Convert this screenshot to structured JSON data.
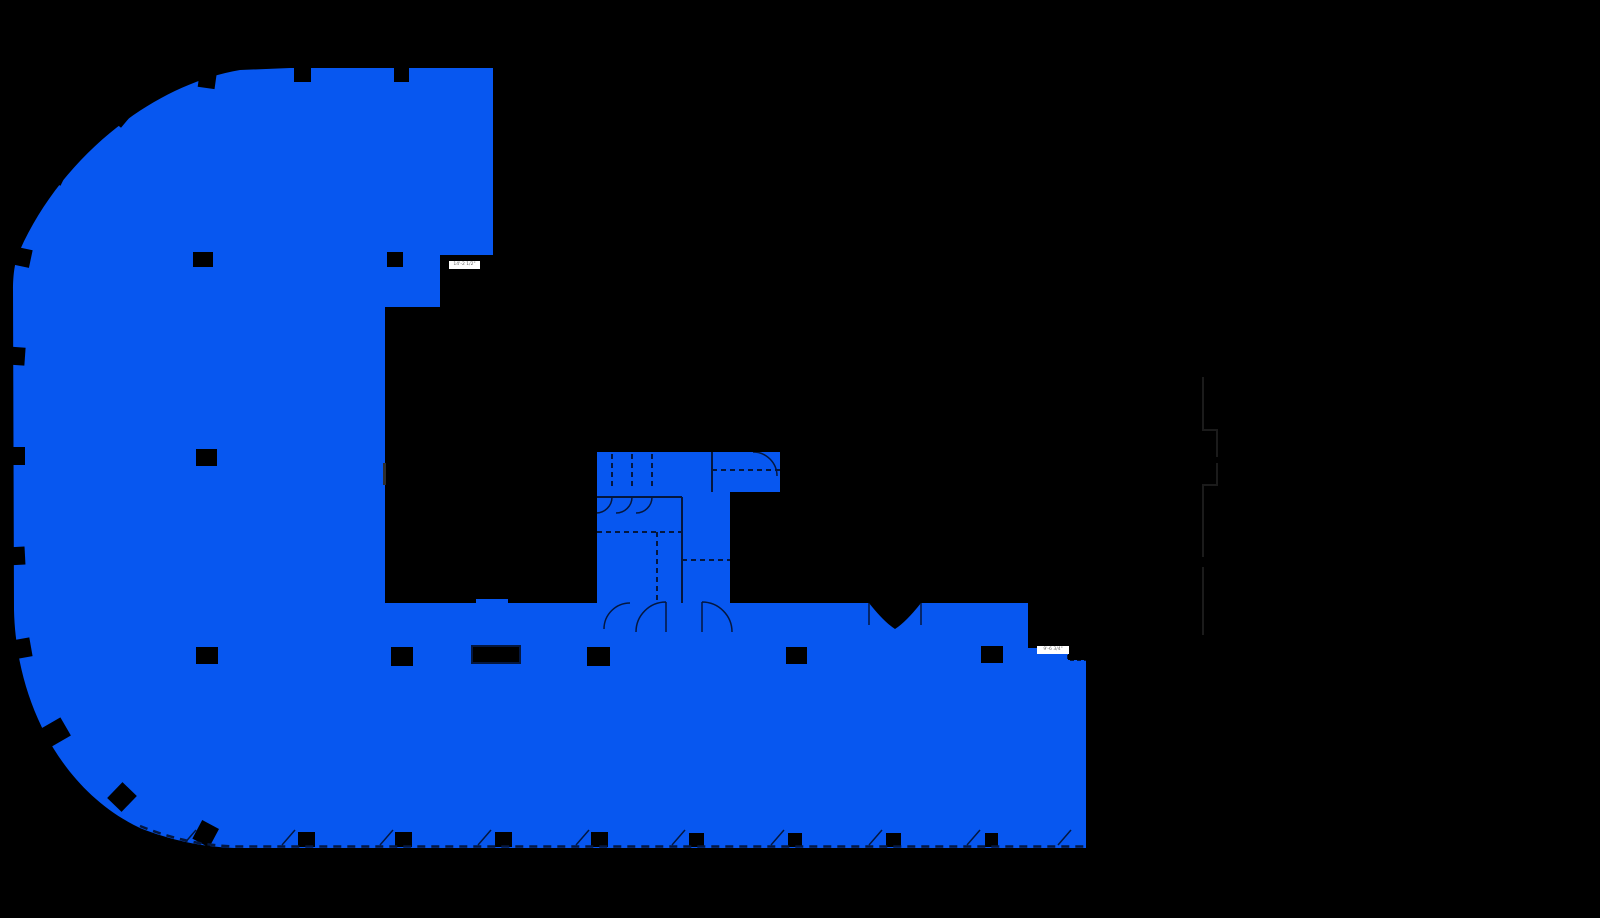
{
  "scene": {
    "description": "Building floor plan with one large highlighted area on black background",
    "background_color": "#000000"
  },
  "highlight": {
    "name": "Highlighted suite area",
    "color": "#0757f0"
  },
  "linework": {
    "interior_color": "#04173f",
    "faint_color": "#1b1b1b",
    "column_color": "#000000",
    "edge_sliver_color": "#2e2e2e"
  },
  "dimension_labels": {
    "dim1": {
      "text": "14'-2 1/2\""
    },
    "dim2": {
      "text": "9'-6 3/4\""
    }
  }
}
